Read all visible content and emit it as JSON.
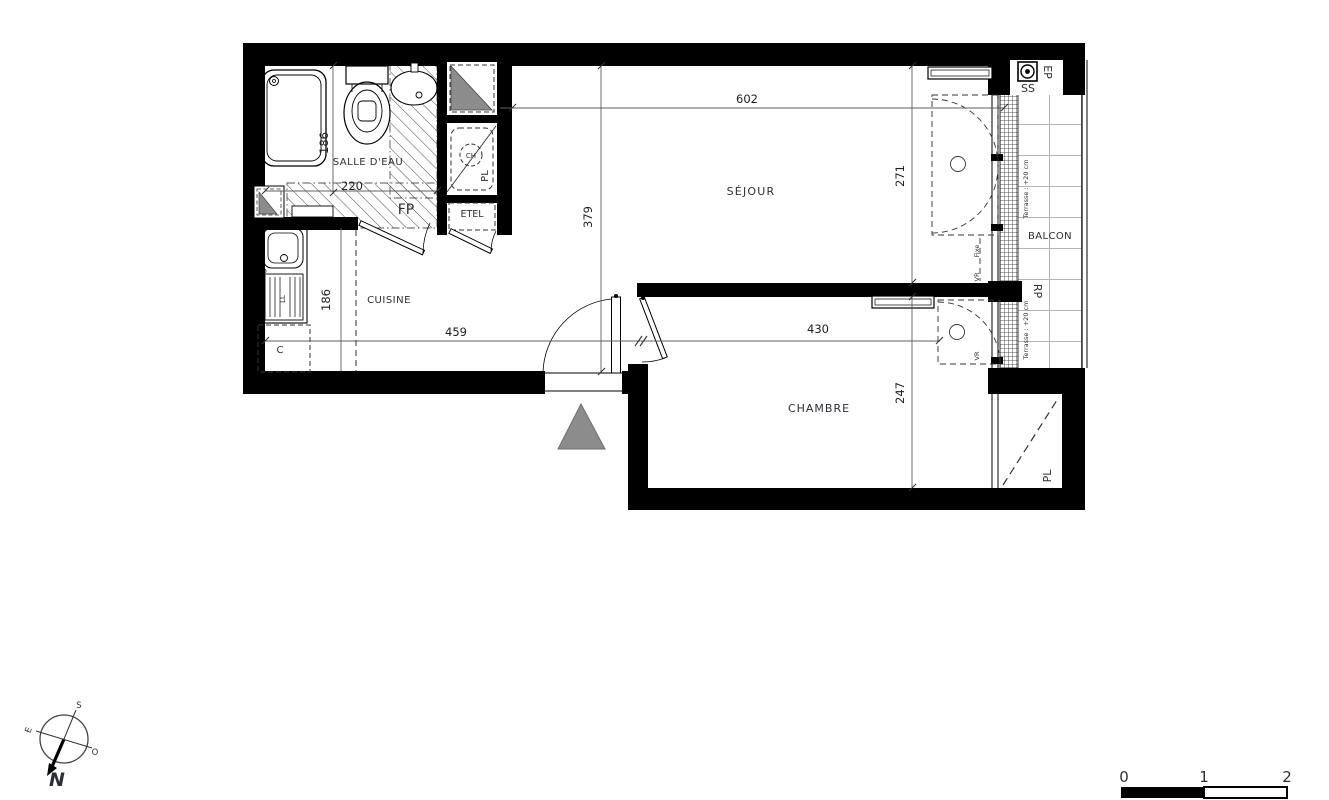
{
  "plan": {
    "rooms": {
      "salle_deau": "SALLE D'EAU",
      "cuisine": "CUISINE",
      "sejour": "SÉJOUR",
      "chambre": "CHAMBRE",
      "balcon": "BALCON"
    },
    "dimensions": {
      "sdb_depth": "186",
      "sdb_width": "220",
      "cuisine_depth": "186",
      "cuisine_width": "459",
      "sejour_width": "602",
      "sejour_depth": "379",
      "sejour_window": "271",
      "chambre_width": "430",
      "chambre_depth": "247"
    },
    "annotations": {
      "fp": "FP",
      "etel": "ETEL",
      "pl": "PL",
      "ch": "CH",
      "c": "C",
      "ll": "LL",
      "ep": "EP",
      "ss": "SS",
      "rp": "RP",
      "fixe": "Fixe",
      "vr": "VR",
      "terrasse": "Terrasse : +20 cm"
    },
    "compass": {
      "n": "N",
      "s": "S",
      "e": "E",
      "o": "O"
    },
    "scale_bar": {
      "t0": "0",
      "t1": "1",
      "t2": "2"
    },
    "colors": {
      "wall": "#000000",
      "triangle": "#8c8c8c",
      "hatch": "#4a4a4a",
      "tile": "#b5b5b5",
      "dim": "#5f5f5f",
      "text": "#2d2f36"
    }
  }
}
